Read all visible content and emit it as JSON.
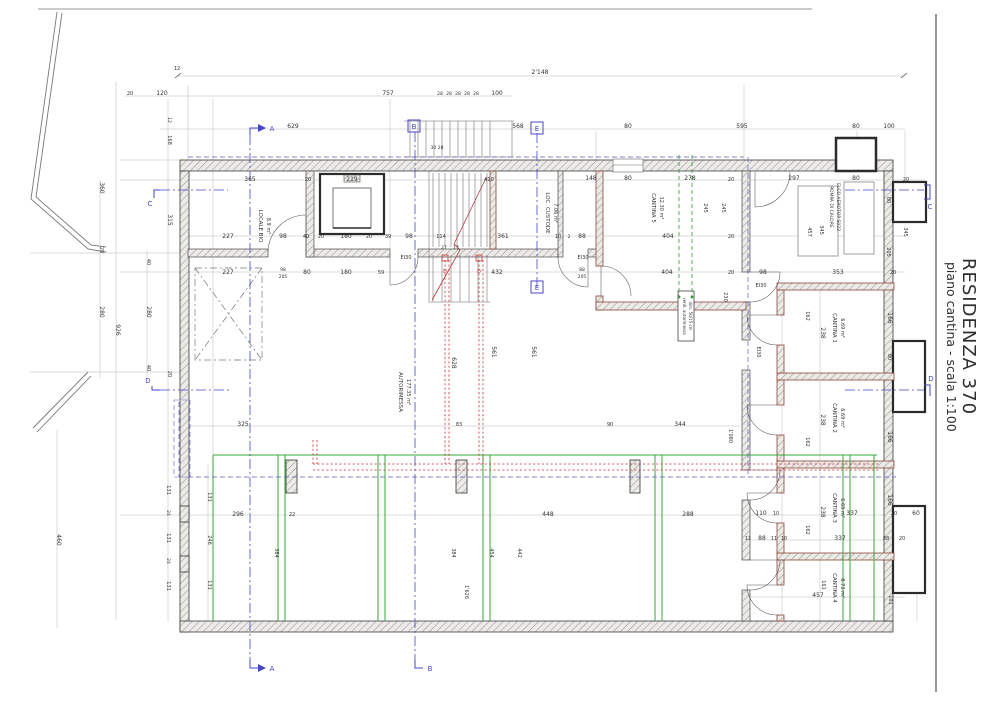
{
  "title_block": {
    "line1": "RESIDENZA 370",
    "line2": "piano cantina - scala 1:100"
  },
  "palette": {
    "text": "#333333",
    "blue": "#4646c8",
    "red": "#cc3333",
    "green": "#3aa53a",
    "wall_outline": "#3c3c3c",
    "cantina_wall": "#8a4539"
  },
  "annotations": [
    {
      "t": "2'148",
      "x": 540,
      "y": 74
    },
    {
      "t": "12",
      "x": 177,
      "y": 70,
      "s": 5
    },
    {
      "t": "20",
      "x": 130,
      "y": 95,
      "s": 5
    },
    {
      "t": "120",
      "x": 162,
      "y": 95
    },
    {
      "t": "757",
      "x": 388,
      "y": 95
    },
    {
      "t": "28",
      "x": 440,
      "y": 95,
      "s": 4.5
    },
    {
      "t": "28",
      "x": 449,
      "y": 95,
      "s": 4.5
    },
    {
      "t": "28",
      "x": 458,
      "y": 95,
      "s": 4.5
    },
    {
      "t": "28",
      "x": 467,
      "y": 95,
      "s": 4.5
    },
    {
      "t": "28",
      "x": 476,
      "y": 95,
      "s": 4.5
    },
    {
      "t": "100",
      "x": 497,
      "y": 95
    },
    {
      "t": "629",
      "x": 293,
      "y": 128
    },
    {
      "t": "568",
      "x": 518,
      "y": 128
    },
    {
      "t": "80",
      "x": 628,
      "y": 128
    },
    {
      "t": "595",
      "x": 742,
      "y": 128
    },
    {
      "t": "80",
      "x": 856,
      "y": 128
    },
    {
      "t": "100",
      "x": 889,
      "y": 128
    },
    {
      "t": "365",
      "x": 250,
      "y": 181
    },
    {
      "t": "20",
      "x": 308,
      "y": 181,
      "s": 5
    },
    {
      "t": "219",
      "x": 352,
      "y": 181
    },
    {
      "t": "30 28",
      "x": 437,
      "y": 149,
      "s": 4.5
    },
    {
      "t": "410",
      "x": 489,
      "y": 181,
      "s": 5
    },
    {
      "t": "148",
      "x": 591,
      "y": 180
    },
    {
      "t": "80",
      "x": 628,
      "y": 180
    },
    {
      "t": "278",
      "x": 690,
      "y": 180
    },
    {
      "t": "20",
      "x": 731,
      "y": 181,
      "s": 5
    },
    {
      "t": "297",
      "x": 794,
      "y": 180
    },
    {
      "t": "80",
      "x": 856,
      "y": 180
    },
    {
      "t": "20",
      "x": 906,
      "y": 181,
      "s": 5
    },
    {
      "t": "227",
      "x": 228,
      "y": 238
    },
    {
      "t": "98",
      "x": 283,
      "y": 238
    },
    {
      "t": "40",
      "x": 306,
      "y": 238,
      "s": 5
    },
    {
      "t": "20",
      "x": 321,
      "y": 238,
      "s": 5
    },
    {
      "t": "180",
      "x": 346,
      "y": 238
    },
    {
      "t": "20",
      "x": 369,
      "y": 238,
      "s": 5
    },
    {
      "t": "39",
      "x": 388,
      "y": 238,
      "s": 5
    },
    {
      "t": "98",
      "x": 409,
      "y": 238
    },
    {
      "t": "114",
      "x": 441,
      "y": 238,
      "s": 5
    },
    {
      "t": "361",
      "x": 503,
      "y": 238
    },
    {
      "t": "10",
      "x": 558,
      "y": 238,
      "s": 5
    },
    {
      "t": "2",
      "x": 569,
      "y": 238,
      "s": 4.5
    },
    {
      "t": "88",
      "x": 582,
      "y": 238
    },
    {
      "t": "404",
      "x": 668,
      "y": 238
    },
    {
      "t": "20",
      "x": 731,
      "y": 238,
      "s": 5
    },
    {
      "t": "227",
      "x": 228,
      "y": 274
    },
    {
      "t": "98",
      "x": 283,
      "y": 271,
      "s": 4.5
    },
    {
      "t": "205",
      "x": 283,
      "y": 278,
      "s": 4.5
    },
    {
      "t": "80",
      "x": 307,
      "y": 274
    },
    {
      "t": "180",
      "x": 346,
      "y": 274
    },
    {
      "t": "59",
      "x": 381,
      "y": 274,
      "s": 5
    },
    {
      "t": "432",
      "x": 497,
      "y": 274
    },
    {
      "t": "88",
      "x": 582,
      "y": 271,
      "s": 4.5
    },
    {
      "t": "205",
      "x": 582,
      "y": 278,
      "s": 4.5
    },
    {
      "t": "404",
      "x": 667,
      "y": 274
    },
    {
      "t": "20",
      "x": 731,
      "y": 274,
      "s": 5
    },
    {
      "t": "98",
      "x": 763,
      "y": 274
    },
    {
      "t": "353",
      "x": 838,
      "y": 274
    },
    {
      "t": "20",
      "x": 893,
      "y": 274,
      "s": 5
    },
    {
      "t": "360",
      "x": 100,
      "y": 188,
      "r": 90
    },
    {
      "t": "20",
      "x": 100,
      "y": 250,
      "r": 90,
      "s": 5
    },
    {
      "t": "280",
      "x": 100,
      "y": 312,
      "r": 90
    },
    {
      "t": "926",
      "x": 116,
      "y": 330,
      "r": 90
    },
    {
      "t": "280",
      "x": 147,
      "y": 312,
      "r": 90
    },
    {
      "t": "40",
      "x": 147,
      "y": 262,
      "r": 90,
      "s": 5
    },
    {
      "t": "40",
      "x": 147,
      "y": 368,
      "r": 90,
      "s": 5
    },
    {
      "t": "12",
      "x": 168,
      "y": 120,
      "r": 90,
      "s": 4.5
    },
    {
      "t": "168",
      "x": 168,
      "y": 140,
      "r": 90,
      "s": 5
    },
    {
      "t": "315",
      "x": 168,
      "y": 220,
      "r": 90
    },
    {
      "t": "20",
      "x": 168,
      "y": 374,
      "r": 90,
      "s": 5
    },
    {
      "t": "460",
      "x": 57,
      "y": 540,
      "r": 90
    },
    {
      "t": "245",
      "x": 704,
      "y": 208,
      "r": 90,
      "s": 5
    },
    {
      "t": "245",
      "x": 722,
      "y": 208,
      "r": 90,
      "s": 5
    },
    {
      "t": "230",
      "x": 724,
      "y": 297,
      "r": 90,
      "s": 5
    },
    {
      "t": "1'080",
      "x": 729,
      "y": 436,
      "r": 90,
      "s": 5
    },
    {
      "t": "457",
      "x": 808,
      "y": 232,
      "r": 90,
      "s": 5
    },
    {
      "t": "345",
      "x": 820,
      "y": 230,
      "r": 90,
      "s": 5
    },
    {
      "t": "345",
      "x": 904,
      "y": 232,
      "r": 90,
      "s": 5
    },
    {
      "t": "80",
      "x": 887,
      "y": 200,
      "r": 90,
      "s": 5
    },
    {
      "t": "205",
      "x": 887,
      "y": 252,
      "r": 90,
      "s": 5
    },
    {
      "t": "162",
      "x": 806,
      "y": 316,
      "r": 90,
      "s": 5
    },
    {
      "t": "238",
      "x": 821,
      "y": 333,
      "r": 90
    },
    {
      "t": "166",
      "x": 888,
      "y": 318,
      "r": 90
    },
    {
      "t": "80",
      "x": 888,
      "y": 357,
      "r": 90,
      "s": 5
    },
    {
      "t": "238",
      "x": 821,
      "y": 420,
      "r": 90
    },
    {
      "t": "162",
      "x": 806,
      "y": 442,
      "r": 90,
      "s": 5
    },
    {
      "t": "166",
      "x": 888,
      "y": 437,
      "r": 90
    },
    {
      "t": "166",
      "x": 888,
      "y": 500,
      "r": 90
    },
    {
      "t": "238",
      "x": 821,
      "y": 512,
      "r": 90
    },
    {
      "t": "162",
      "x": 806,
      "y": 530,
      "r": 90,
      "s": 5
    },
    {
      "t": "161",
      "x": 822,
      "y": 585,
      "r": 90,
      "s": 5
    },
    {
      "t": "101",
      "x": 889,
      "y": 600,
      "r": 90,
      "s": 5
    },
    {
      "t": "325",
      "x": 243,
      "y": 426
    },
    {
      "t": "83",
      "x": 459,
      "y": 426,
      "s": 5
    },
    {
      "t": "90",
      "x": 610,
      "y": 426,
      "s": 5
    },
    {
      "t": "344",
      "x": 680,
      "y": 426
    },
    {
      "t": "628",
      "x": 452,
      "y": 363,
      "r": 90
    },
    {
      "t": "561",
      "x": 492,
      "y": 352,
      "r": 90
    },
    {
      "t": "561",
      "x": 532,
      "y": 352,
      "r": 90
    },
    {
      "t": "296",
      "x": 238,
      "y": 516
    },
    {
      "t": "22",
      "x": 292,
      "y": 516,
      "s": 5
    },
    {
      "t": "448",
      "x": 548,
      "y": 516
    },
    {
      "t": "288",
      "x": 688,
      "y": 516
    },
    {
      "t": "110",
      "x": 761,
      "y": 515
    },
    {
      "t": "10",
      "x": 776,
      "y": 515,
      "s": 5
    },
    {
      "t": "337",
      "x": 852,
      "y": 515
    },
    {
      "t": "20",
      "x": 894,
      "y": 515,
      "s": 5
    },
    {
      "t": "60",
      "x": 916,
      "y": 515
    },
    {
      "t": "11",
      "x": 748,
      "y": 540,
      "s": 5
    },
    {
      "t": "88",
      "x": 762,
      "y": 540
    },
    {
      "t": "11",
      "x": 774,
      "y": 540,
      "s": 5
    },
    {
      "t": "10",
      "x": 784,
      "y": 540,
      "s": 5
    },
    {
      "t": "337",
      "x": 840,
      "y": 540
    },
    {
      "t": "88",
      "x": 886,
      "y": 540,
      "s": 5
    },
    {
      "t": "20",
      "x": 902,
      "y": 540,
      "s": 5
    },
    {
      "t": "457",
      "x": 818,
      "y": 597
    },
    {
      "t": "131",
      "x": 167,
      "y": 490,
      "r": 90,
      "s": 5
    },
    {
      "t": "24",
      "x": 167,
      "y": 513,
      "r": 90,
      "s": 4.5
    },
    {
      "t": "131",
      "x": 167,
      "y": 538,
      "r": 90,
      "s": 5
    },
    {
      "t": "24",
      "x": 167,
      "y": 561,
      "r": 90,
      "s": 4.5
    },
    {
      "t": "131",
      "x": 167,
      "y": 586,
      "r": 90,
      "s": 5
    },
    {
      "t": "131",
      "x": 208,
      "y": 497,
      "r": 90,
      "s": 5
    },
    {
      "t": "246",
      "x": 208,
      "y": 540,
      "r": 90,
      "s": 5
    },
    {
      "t": "131",
      "x": 208,
      "y": 585,
      "r": 90,
      "s": 5
    },
    {
      "t": "384",
      "x": 275,
      "y": 553,
      "r": 90,
      "s": 5
    },
    {
      "t": "384",
      "x": 452,
      "y": 553,
      "r": 90,
      "s": 5
    },
    {
      "t": "454",
      "x": 490,
      "y": 553,
      "r": 90,
      "s": 5
    },
    {
      "t": "442",
      "x": 518,
      "y": 553,
      "r": 90,
      "s": 5
    },
    {
      "t": "1'626",
      "x": 465,
      "y": 592,
      "r": 90,
      "s": 5
    },
    {
      "t": "27",
      "x": 444,
      "y": 249,
      "s": 4.5
    },
    {
      "t": "17",
      "x": 456,
      "y": 249,
      "s": 4.5
    },
    {
      "t": "EI30",
      "x": 406,
      "y": 259,
      "s": 5
    },
    {
      "t": "EI30",
      "x": 583,
      "y": 259,
      "s": 5
    },
    {
      "t": "EI30",
      "x": 761,
      "y": 287,
      "s": 5
    },
    {
      "t": "EI30",
      "x": 757,
      "y": 352,
      "r": 90,
      "s": 5
    },
    {
      "t": "LOCALE BIO",
      "x": 259,
      "y": 226,
      "r": 90,
      "s": 5.5
    },
    {
      "t": "8.9 m²",
      "x": 267,
      "y": 226,
      "r": 90,
      "s": 5
    },
    {
      "t": "LOC. CUSTODE",
      "x": 546,
      "y": 213,
      "r": 90,
      "s": 5.5
    },
    {
      "t": "7.06 m²",
      "x": 554,
      "y": 213,
      "r": 90,
      "s": 5
    },
    {
      "t": "CANTINA 5",
      "x": 652,
      "y": 208,
      "r": 90,
      "s": 5.5
    },
    {
      "t": "12.30 m²",
      "x": 660,
      "y": 208,
      "r": 90,
      "s": 5
    },
    {
      "t": "AUTORIMESSA",
      "x": 399,
      "y": 392,
      "r": 90,
      "s": 5.5
    },
    {
      "t": "177.35 m²",
      "x": 407,
      "y": 392,
      "r": 90,
      "s": 5
    },
    {
      "t": "CANTINA 1",
      "x": 833,
      "y": 328,
      "r": 90,
      "s": 5.5
    },
    {
      "t": "6.69 m²",
      "x": 841,
      "y": 328,
      "r": 90,
      "s": 5
    },
    {
      "t": "CANTINA 2",
      "x": 833,
      "y": 418,
      "r": 90,
      "s": 5.5
    },
    {
      "t": "6.69 m²",
      "x": 841,
      "y": 418,
      "r": 90,
      "s": 5
    },
    {
      "t": "CANTINA 3",
      "x": 833,
      "y": 508,
      "r": 90,
      "s": 5.5
    },
    {
      "t": "6.69 m²",
      "x": 841,
      "y": 508,
      "r": 90,
      "s": 5
    },
    {
      "t": "CANTINA 4",
      "x": 833,
      "y": 588,
      "r": 90,
      "s": 5.5
    },
    {
      "t": "8.73 m²",
      "x": 841,
      "y": 588,
      "r": 90,
      "s": 5
    },
    {
      "t": "POMPA DI CALORE",
      "x": 830,
      "y": 207,
      "r": 90,
      "s": 4.5
    },
    {
      "t": "ELCO AEROTOP S022",
      "x": 837,
      "y": 207,
      "r": 90,
      "s": 4.5
    },
    {
      "t": "venti. autorimessa",
      "x": 683,
      "y": 316,
      "r": 90,
      "s": 4
    },
    {
      "t": "dim. 50/15 cm",
      "x": 689,
      "y": 316,
      "r": 90,
      "s": 4
    },
    {
      "t": "A",
      "x": 272,
      "y": 131,
      "c": "#4646c8",
      "s": 7
    },
    {
      "t": "A",
      "x": 272,
      "y": 671,
      "c": "#4646c8",
      "s": 7
    },
    {
      "t": "B",
      "x": 414,
      "y": 129,
      "c": "#4646c8",
      "s": 7
    },
    {
      "t": "B",
      "x": 430,
      "y": 671,
      "c": "#4646c8",
      "s": 7
    },
    {
      "t": "C",
      "x": 150,
      "y": 206,
      "c": "#4646c8",
      "s": 7
    },
    {
      "t": "C",
      "x": 930,
      "y": 209,
      "c": "#4646c8",
      "s": 7
    },
    {
      "t": "D",
      "x": 148,
      "y": 383,
      "c": "#4646c8",
      "s": 7
    },
    {
      "t": "D",
      "x": 931,
      "y": 381,
      "c": "#4646c8",
      "s": 7
    },
    {
      "t": "E",
      "x": 537,
      "y": 131,
      "c": "#4646c8",
      "s": 7
    },
    {
      "t": "E",
      "x": 537,
      "y": 290,
      "c": "#4646c8",
      "s": 7
    },
    {
      "t": "D",
      "x": 445,
      "y": 273,
      "c": "#cc3333",
      "s": 5
    },
    {
      "t": "D",
      "x": 479,
      "y": 273,
      "c": "#cc3333",
      "s": 5
    }
  ]
}
